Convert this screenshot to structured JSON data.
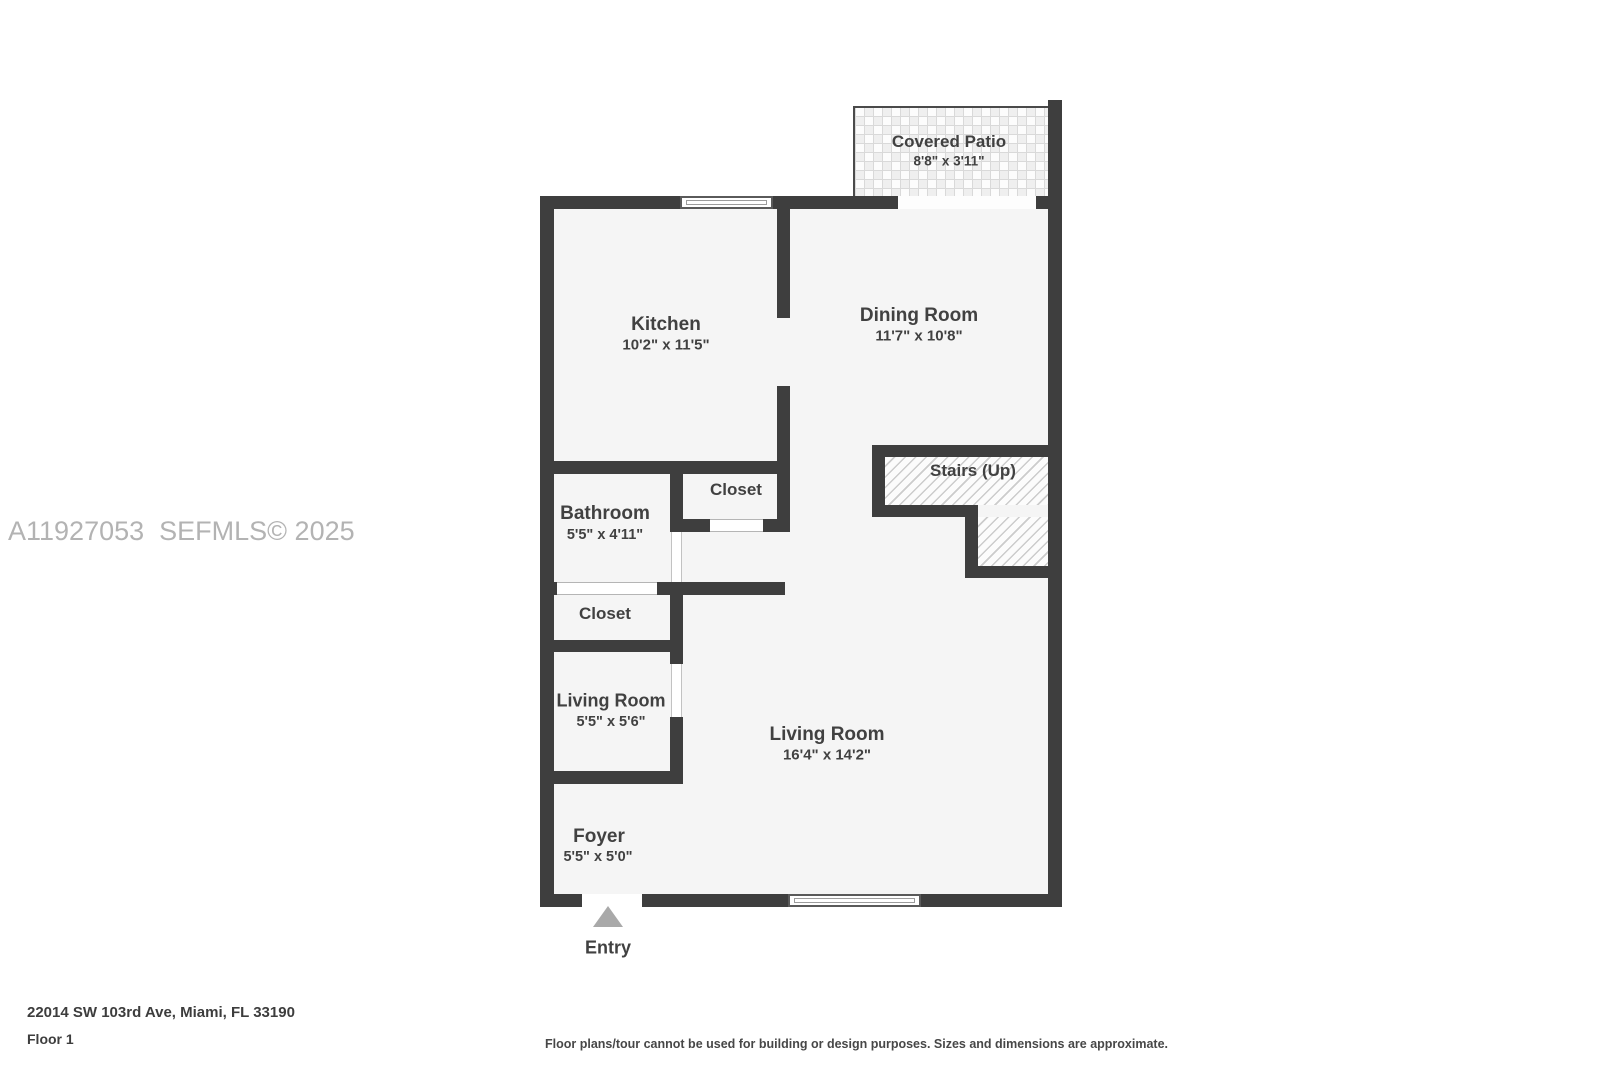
{
  "watermark": "A11927053  SEFMLS© 2025",
  "rooms": {
    "covered_patio": {
      "name": "Covered Patio",
      "dims": "8'8\" x 3'11\""
    },
    "kitchen": {
      "name": "Kitchen",
      "dims": "10'2\" x 11'5\""
    },
    "dining_room": {
      "name": "Dining Room",
      "dims": "11'7\" x 10'8\""
    },
    "stairs": {
      "name": "Stairs (Up)"
    },
    "closet_upper": {
      "name": "Closet"
    },
    "bathroom": {
      "name": "Bathroom",
      "dims": "5'5\" x 4'11\""
    },
    "closet_lower": {
      "name": "Closet"
    },
    "living_room_small": {
      "name": "Living Room",
      "dims": "5'5\" x 5'6\""
    },
    "living_room_main": {
      "name": "Living Room",
      "dims": "16'4\" x 14'2\""
    },
    "foyer": {
      "name": "Foyer",
      "dims": "5'5\" x 5'0\""
    }
  },
  "entry": {
    "label": "Entry"
  },
  "footer": {
    "address": "22014 SW 103rd Ave, Miami, FL 33190",
    "floor": "Floor 1",
    "disclaimer": "Floor plans/tour cannot be used for building or design purposes. Sizes and dimensions are approximate."
  },
  "colors": {
    "wall": "#3e3e3e",
    "floor": "#f5f5f5",
    "label": "#414141",
    "watermark": "#b3b3b3",
    "entry_arrow": "#a9a9a9"
  }
}
